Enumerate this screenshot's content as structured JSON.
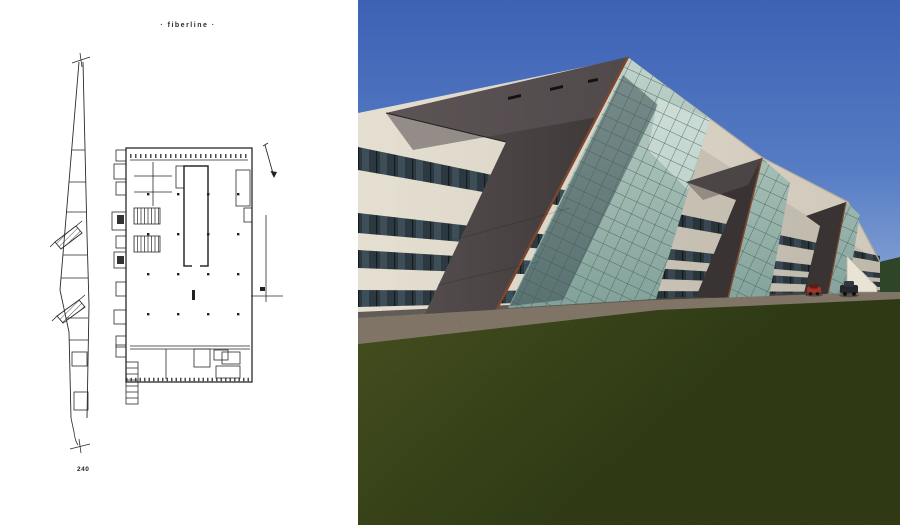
{
  "page": {
    "title": "· fiberline ·",
    "page_number": "240"
  },
  "colors": {
    "paper": "#ffffff",
    "drawing_line": "#2a2a2a",
    "sky_top": "#3d61b4",
    "sky_mid": "#567cc4",
    "sky_horizon": "#8fabd8",
    "treeline": "#2e4527",
    "facade_light": "#e5dfd1",
    "facade_dark": "#cfc8ba",
    "fascia": "#b5ab9c",
    "window_band": "#2d3940",
    "window_line": "#151c20",
    "window_glint": "#5d7586",
    "pylon_light": "#5b5354",
    "pylon_dark": "#393334",
    "roof_sheen": "#5f5758",
    "rust_edge": "#7d462e",
    "glass_light": "#c0d4cb",
    "glass_dark": "#81a199",
    "glass_line": "#3f5751",
    "glass_reflection": "#e9f3ef",
    "glass_shadow": "#32434a",
    "base_shadow": "#4a453f",
    "gravel": "#998f81",
    "gravel_dark": "#6f6354",
    "grass_light": "#6e7637",
    "grass_dark": "#3f4b21",
    "grass_grain": "#26330f",
    "car_red": "#a23424",
    "car_dark": "#24282c"
  }
}
